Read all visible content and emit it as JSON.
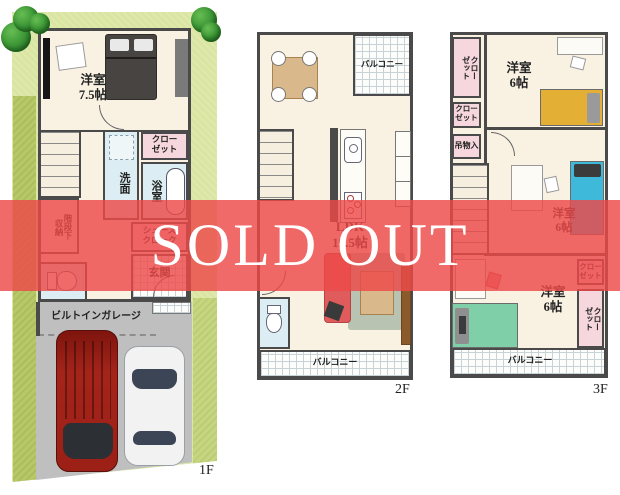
{
  "banner": {
    "text": "SOLD OUT",
    "bg_color": "#ed4949",
    "text_color": "#ffffff"
  },
  "colors": {
    "lot_green": "#d9e5a0",
    "lot_strip_olive": "#b7c967",
    "floor_cream": "#f9f2e3",
    "wall_gray": "#4a4a4a",
    "closet_pink": "#f6d7dd",
    "wet_area_blue": "#dceef3",
    "garage_gray": "#bfbfbf",
    "car_red": "#9e1f16",
    "car_white": "#f2f2f2",
    "bed_yellow": "#e3af35",
    "bed_blue": "#3fb9d9",
    "bed_green": "#7fd0a8"
  },
  "floor1": {
    "label": "1F",
    "bedroom": "洋室\n7.5帖",
    "closet": "クロー\nゼット",
    "washroom": "洗面",
    "bath": "浴室",
    "stair_storage": "階段下\n収納",
    "shoes_closet": "シューズ\nクローク",
    "entrance": "玄関",
    "garage": "ビルトインガレージ"
  },
  "floor2": {
    "label": "2F",
    "balcony_top": "バルコニー",
    "ldk": "LDK\n19.5帖",
    "balcony_bottom": "バルコニー"
  },
  "floor3": {
    "label": "3F",
    "closet_nw": "クロー\nゼット",
    "closet_w": "クロー\nゼット",
    "hanging_storage": "吊物入",
    "bedroom_n": "洋室\n6帖",
    "bedroom_c": "洋室\n6帖",
    "bedroom_s": "洋室\n6帖",
    "closet_e": "クロー\nゼット",
    "closet_se": "クロー\nゼット",
    "balcony": "バルコニー"
  }
}
